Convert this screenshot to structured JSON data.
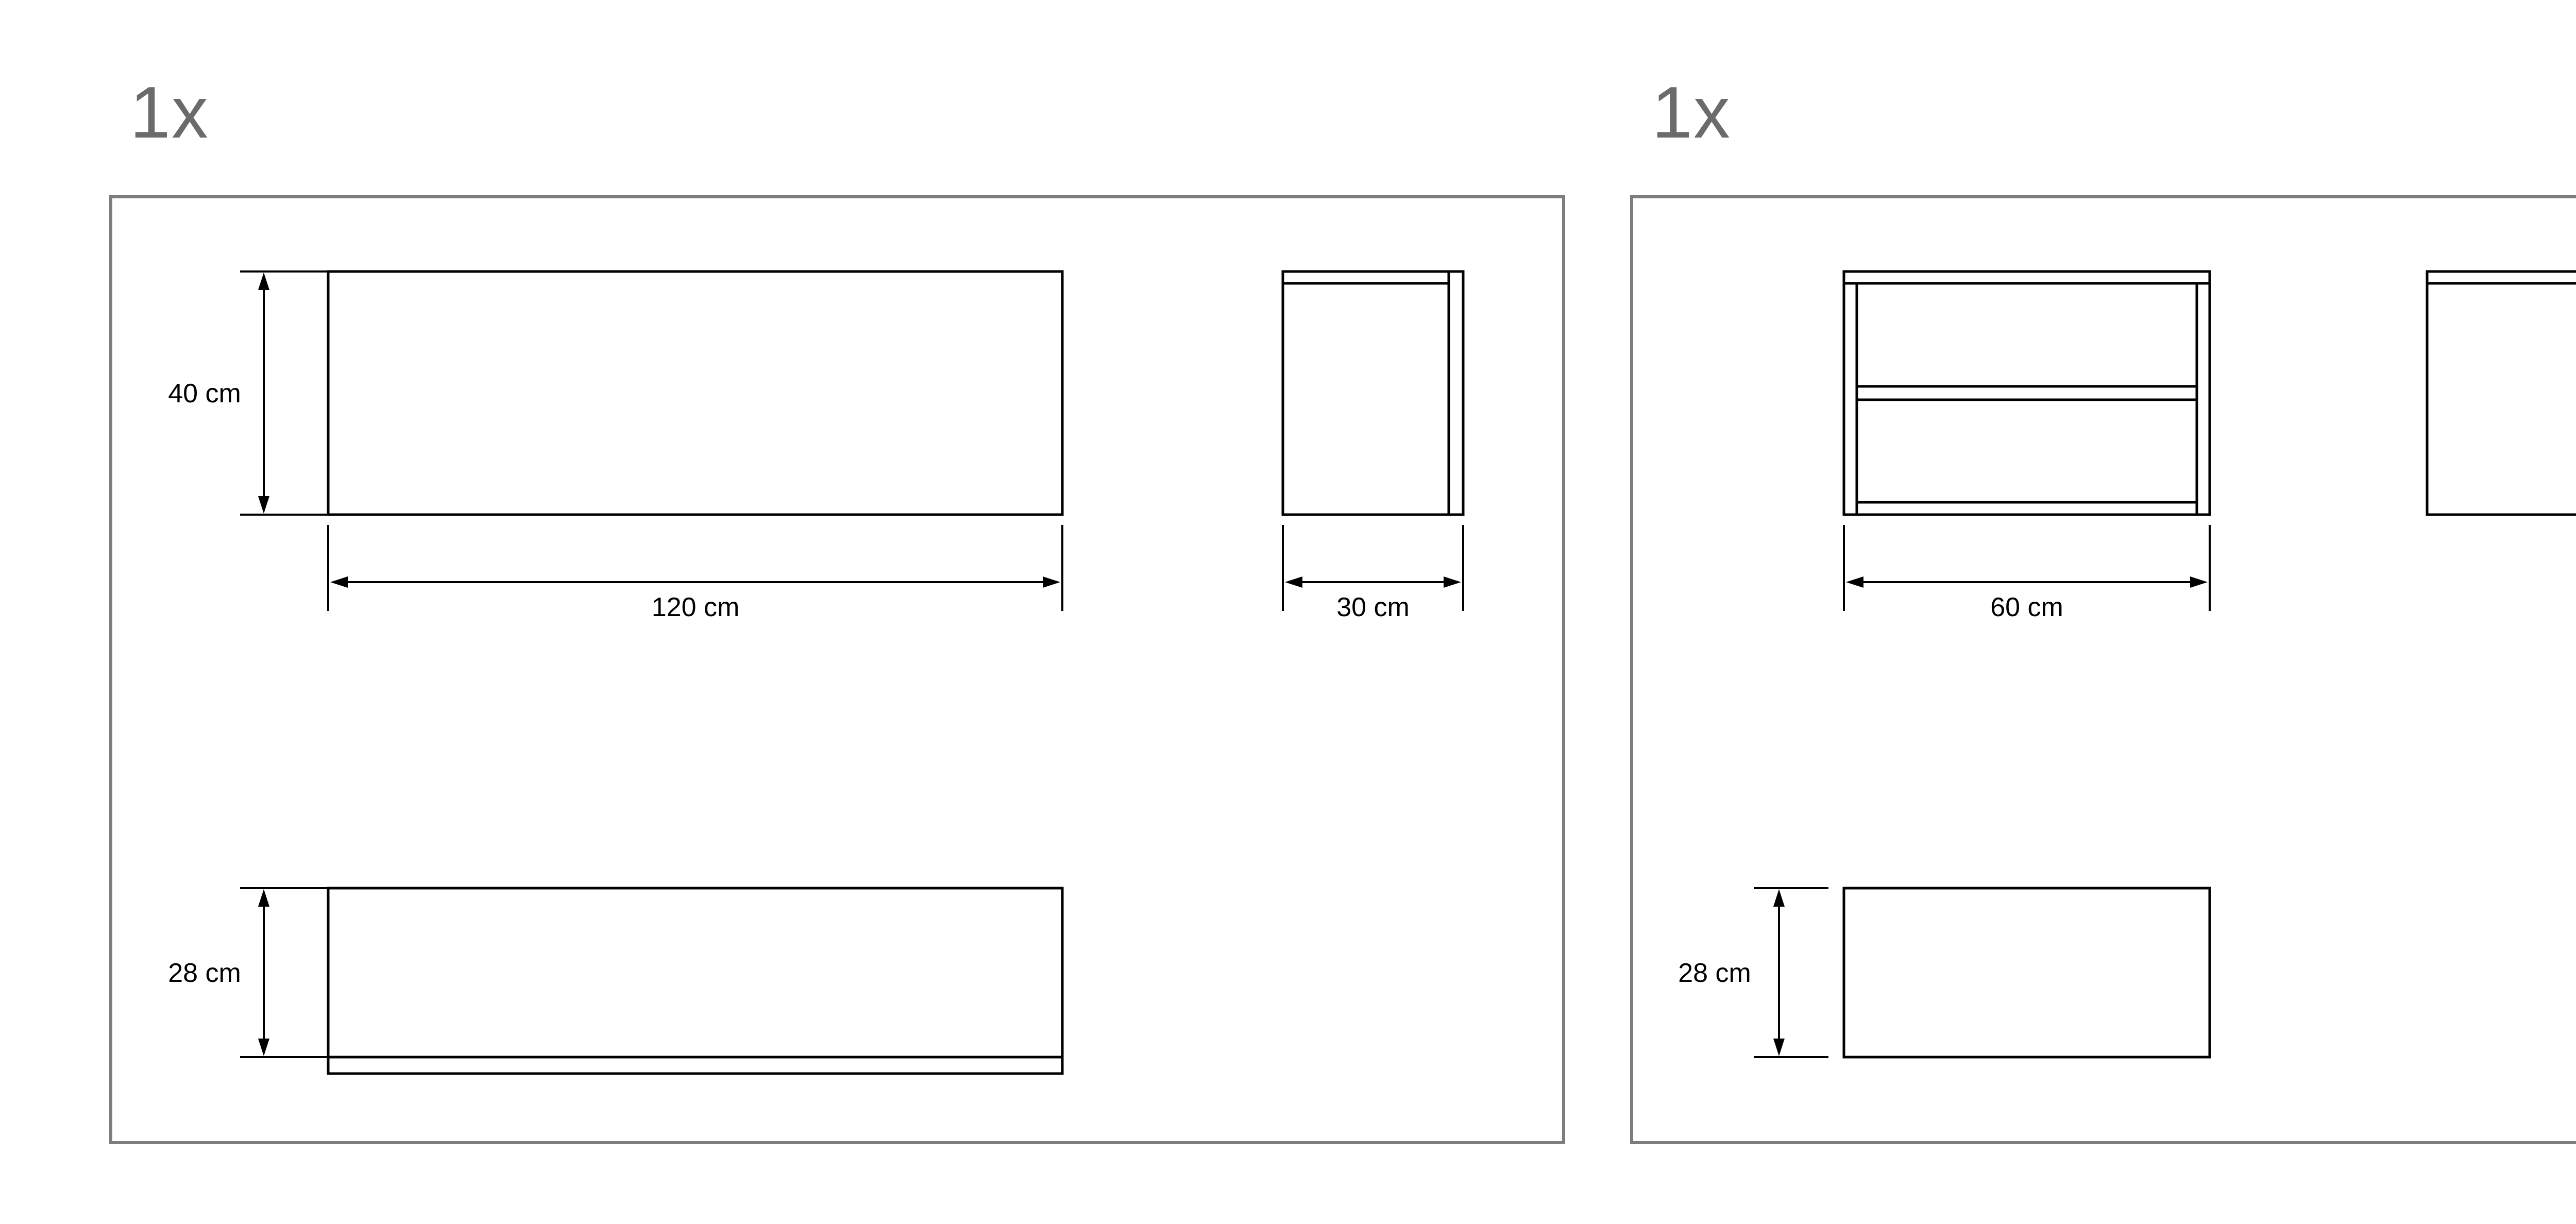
{
  "document": {
    "background": "#ffffff"
  },
  "colors": {
    "drawing_line": "#000000",
    "panel_frame": "#7d7d7d",
    "quantity_text": "#6b6b6b",
    "dimension_text": "#000000"
  },
  "panels": [
    {
      "quantity_label": "1x",
      "front_view": {
        "height_label": "40 cm",
        "width_label": "120 cm"
      },
      "side_view": {
        "width_label": "30 cm"
      },
      "bottom_panel": {
        "height_label": "28 cm"
      }
    },
    {
      "quantity_label": "1x",
      "front_view": {
        "width_label": "60 cm"
      },
      "side_view": {
        "height_label": "40 cm"
      },
      "bottom_panel": {
        "height_label": "28 cm"
      }
    },
    {
      "quantity_label": "1x",
      "front_view": {
        "height_label": "40 cm",
        "width_label": "60 cm"
      },
      "side_view": {
        "width_label": "30 cm"
      },
      "bottom_panel": {
        "height_label": "28 cm"
      }
    }
  ]
}
